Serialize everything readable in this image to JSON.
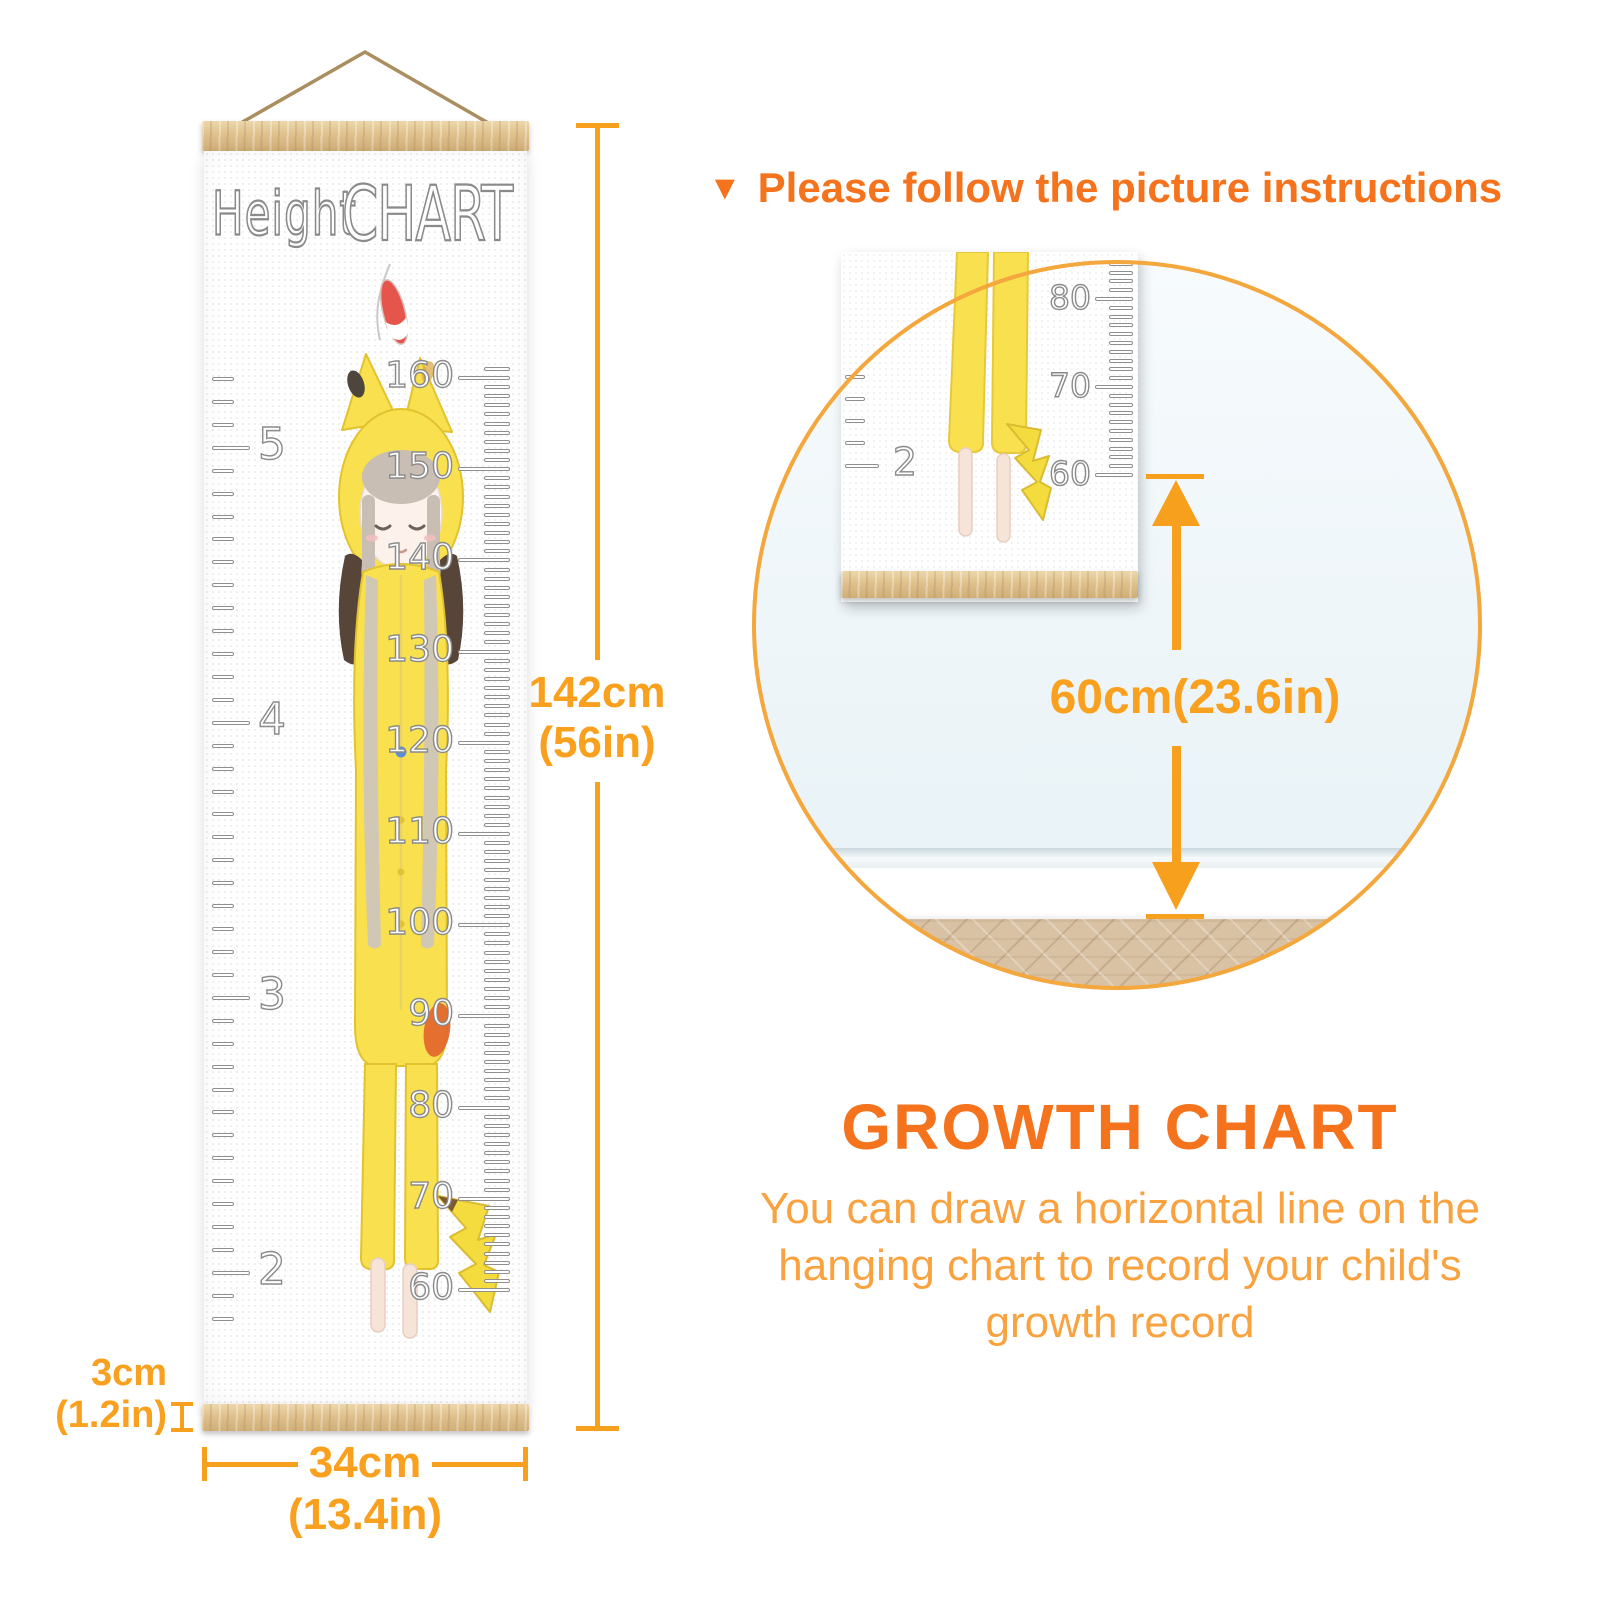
{
  "ruler": {
    "title_word1": "Height",
    "title_word2": "CHART",
    "feet_labels": [
      "5",
      "4",
      "3",
      "2"
    ],
    "cm_labels": [
      "160",
      "150",
      "140",
      "130",
      "120",
      "110",
      "100",
      "90",
      "80",
      "70",
      "60"
    ]
  },
  "dimensions": {
    "height": {
      "value": "142cm",
      "sub": "(56in)"
    },
    "width": {
      "value": "34cm",
      "sub": "(13.4in)"
    },
    "bar": {
      "value": "3cm",
      "sub": "(1.2in)"
    }
  },
  "instruction": {
    "bullet": "▼",
    "text": "Please follow the picture instructions"
  },
  "magnifier": {
    "cm_labels": [
      "80",
      "70",
      "60"
    ],
    "feet_label": "2",
    "measurement": "60cm(23.6in)"
  },
  "growth": {
    "heading": "GROWTH CHART",
    "lines": [
      "You can draw a horizontal line on the",
      "hanging chart to record your child's",
      "growth record"
    ]
  },
  "colors": {
    "accent": "#F6A01D",
    "dim_text": "#F9A01E",
    "heading": "#F4731C",
    "body_text": "#F9A240",
    "circle_border": "#F3A73C",
    "wood": "#DFC18D",
    "costume_yellow": "#F8E04F"
  }
}
